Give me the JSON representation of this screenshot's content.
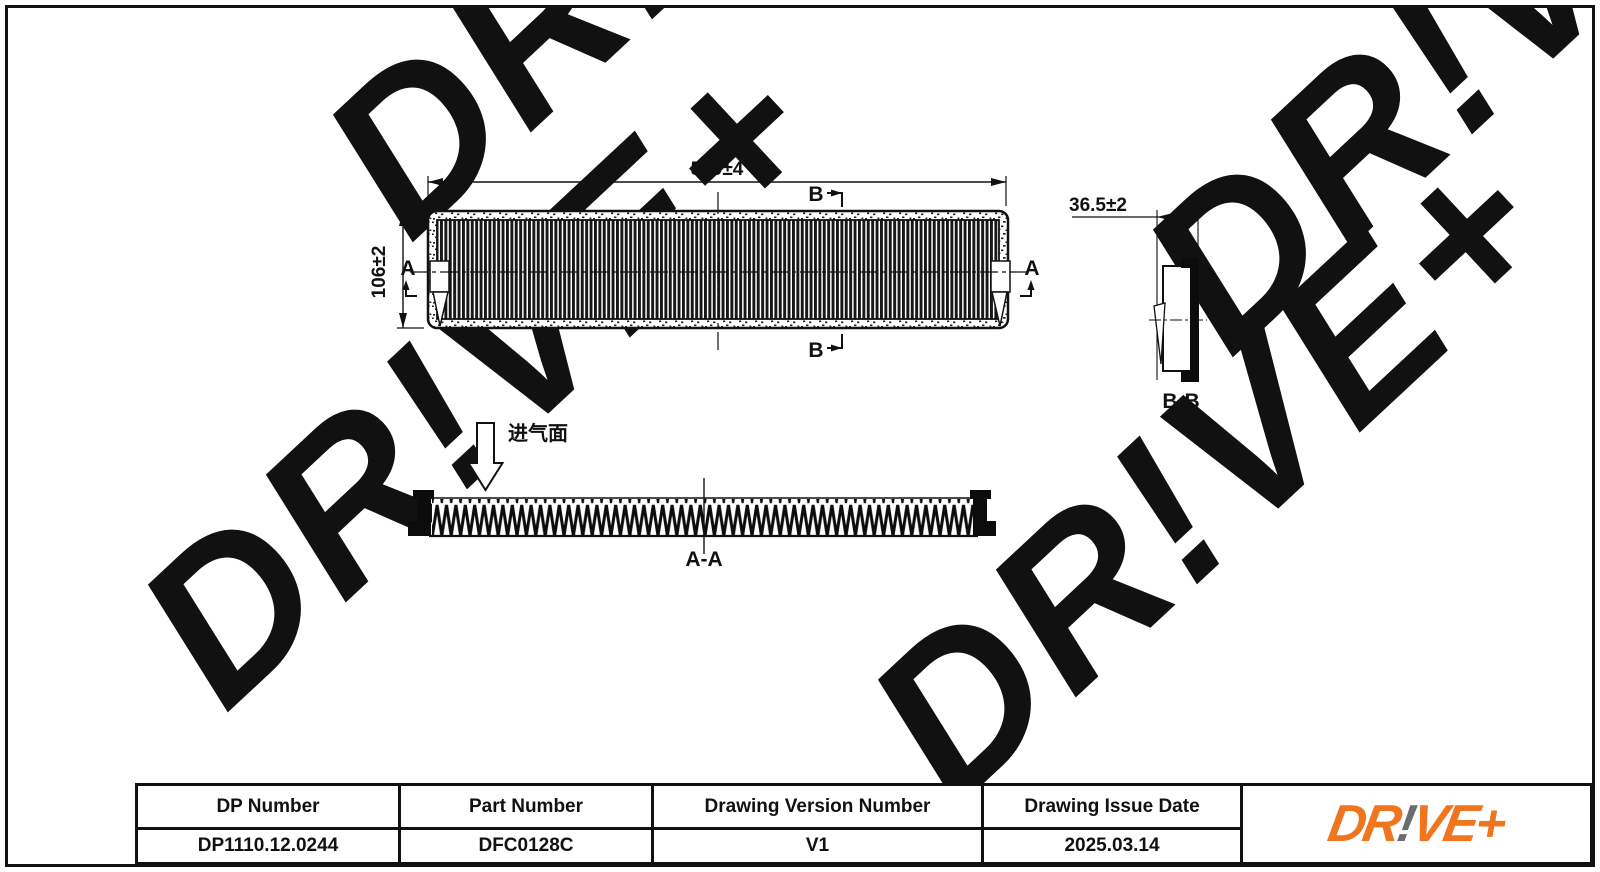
{
  "page": {
    "watermark_text": "DR!VE+",
    "watermark_color": "#EBEBEB",
    "line_color": "#111111"
  },
  "drawing": {
    "top_view": {
      "width_dim": "519±4",
      "height_dim": "106±2",
      "section_a_left": "A",
      "section_a_right": "A",
      "section_b_top": "B",
      "section_b_bottom": "B"
    },
    "section_aa": {
      "label": "A-A",
      "intake_label": "进气面"
    },
    "section_bb": {
      "label": "B-B",
      "width_dim": "36.5±2"
    }
  },
  "title_block": {
    "columns": [
      {
        "header": "DP Number",
        "value": "DP1110.12.0244"
      },
      {
        "header": "Part Number",
        "value": "DFC0128C"
      },
      {
        "header": "Drawing Version Number",
        "value": "V1"
      },
      {
        "header": "Drawing Issue Date",
        "value": "2025.03.14"
      }
    ],
    "logo": {
      "part1": "DR",
      "part2": "!",
      "part3": "VE+",
      "orange": "#F0751F",
      "gray": "#6A6C6E"
    }
  }
}
